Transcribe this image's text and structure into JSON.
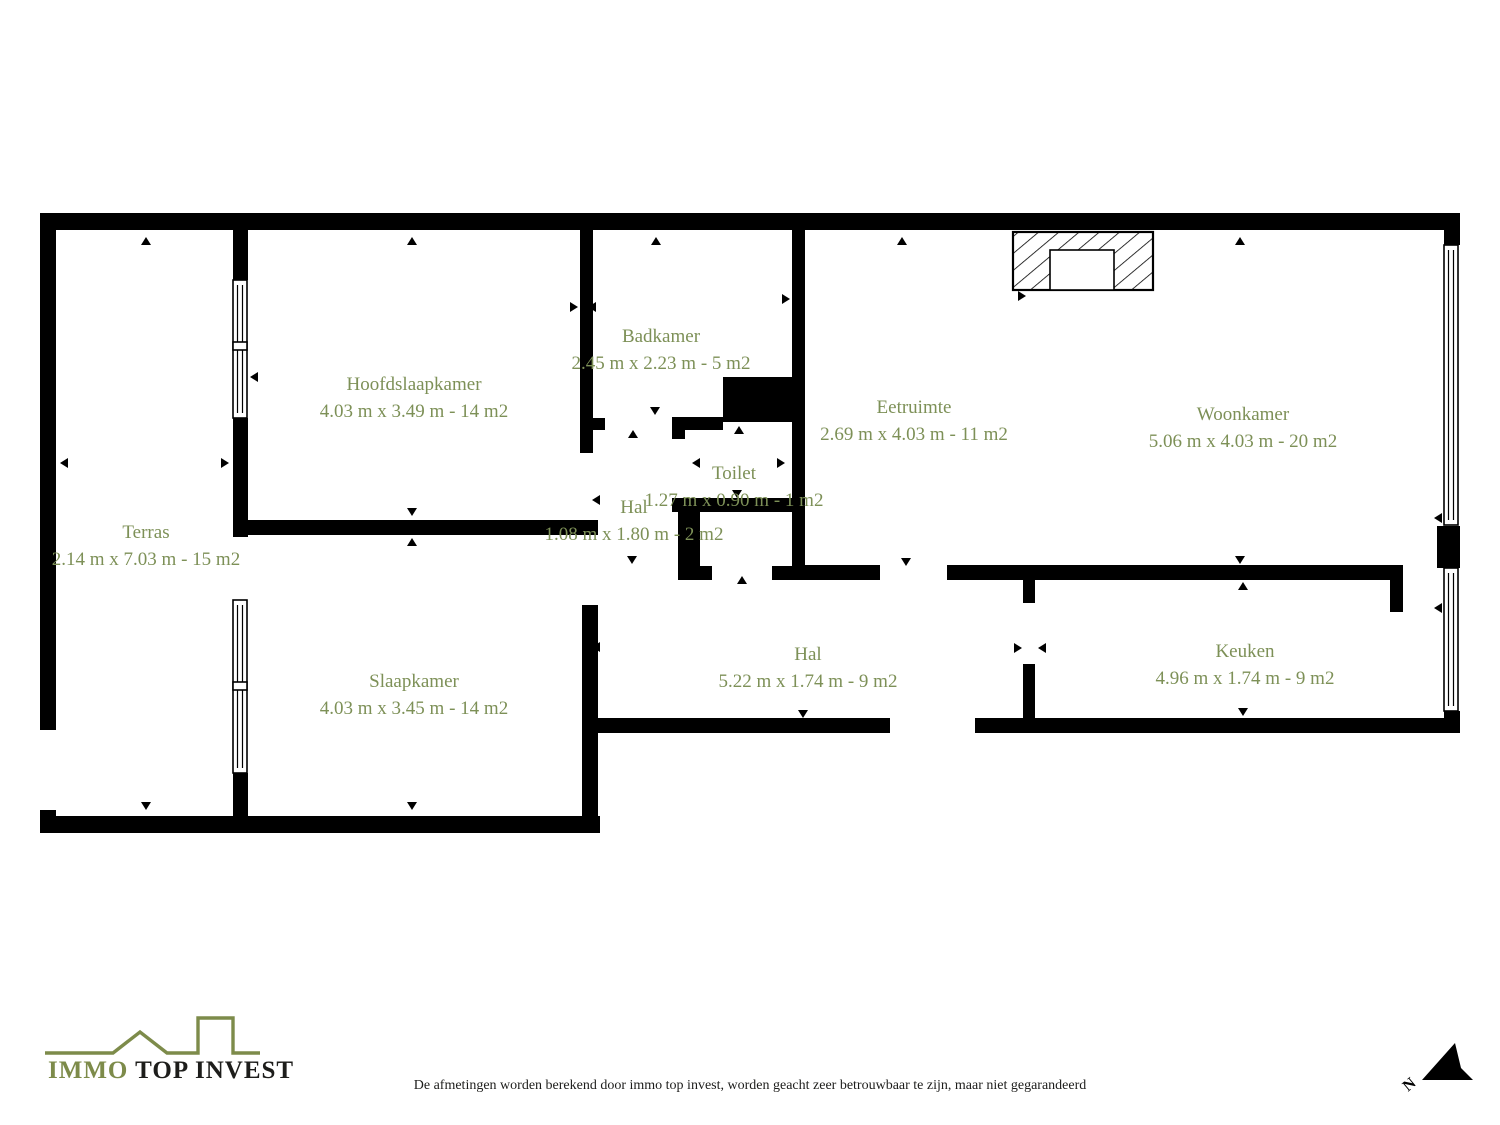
{
  "rooms": [
    {
      "name": "Terras",
      "dims": "2.14 m x 7.03 m - 15 m2"
    },
    {
      "name": "Hoofdslaapkamer",
      "dims": "4.03 m x 3.49 m - 14 m2"
    },
    {
      "name": "Badkamer",
      "dims": "2.45 m x 2.23 m - 5 m2"
    },
    {
      "name": "Toilet",
      "dims": "1.27 m x 0.90 m - 1 m2"
    },
    {
      "name": "Hal",
      "dims": "1.08 m x 1.80 m - 2 m2"
    },
    {
      "name": "Eetruimte",
      "dims": "2.69 m x 4.03 m - 11 m2"
    },
    {
      "name": "Woonkamer",
      "dims": "5.06 m x 4.03 m - 20 m2"
    },
    {
      "name": "Slaapkamer",
      "dims": "4.03 m x 3.45 m - 14 m2"
    },
    {
      "name": "Hal",
      "dims": "5.22 m x 1.74 m - 9 m2"
    },
    {
      "name": "Keuken",
      "dims": "4.96 m x 1.74 m - 9 m2"
    }
  ],
  "footer": {
    "logo_immo": "IMMO",
    "logo_rest": " TOP INVEST",
    "disclaimer": "De afmetingen worden berekend door immo top invest, worden geacht zeer betrouwbaar te zijn, maar niet gegarandeerd",
    "north_label": "N"
  },
  "icons": {
    "logo_roofline": "roofline-with-chimney-icon",
    "north": "north-arrow-icon",
    "fireplace": "fireplace-hatched-icon",
    "markers": "dimension-arrow-markers"
  },
  "colors": {
    "wall": "#000000",
    "room_label": "#7d9057",
    "logo_green": "#7d8b4a",
    "text_dark": "#1d1d1b",
    "background": "#ffffff"
  }
}
